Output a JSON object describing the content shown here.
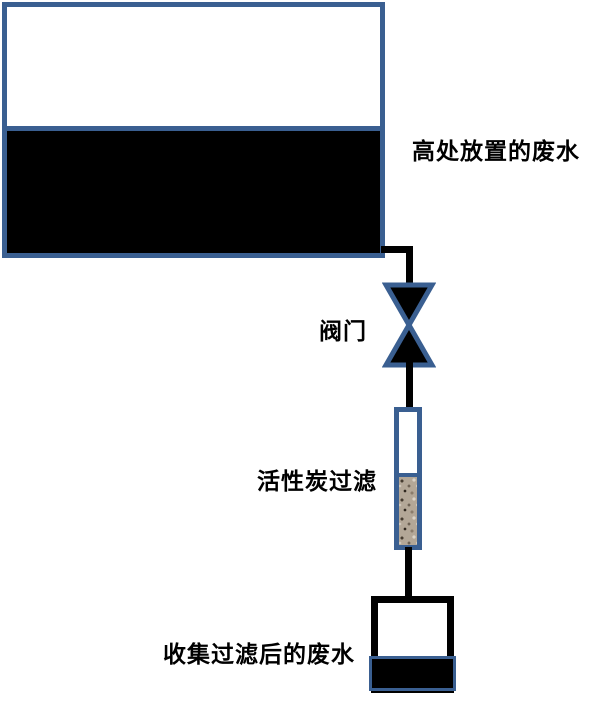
{
  "diagram": {
    "labels": {
      "tank": "高处放置的废水",
      "valve": "阀门",
      "filter": "活性炭过滤",
      "collector": "收集过滤后的废水"
    },
    "colors": {
      "outline_blue": "#3A5F91",
      "liquid_black": "#000000",
      "pipe_black": "#000000",
      "carbon_base": "#B3A797",
      "background": "#FFFFFF"
    }
  }
}
